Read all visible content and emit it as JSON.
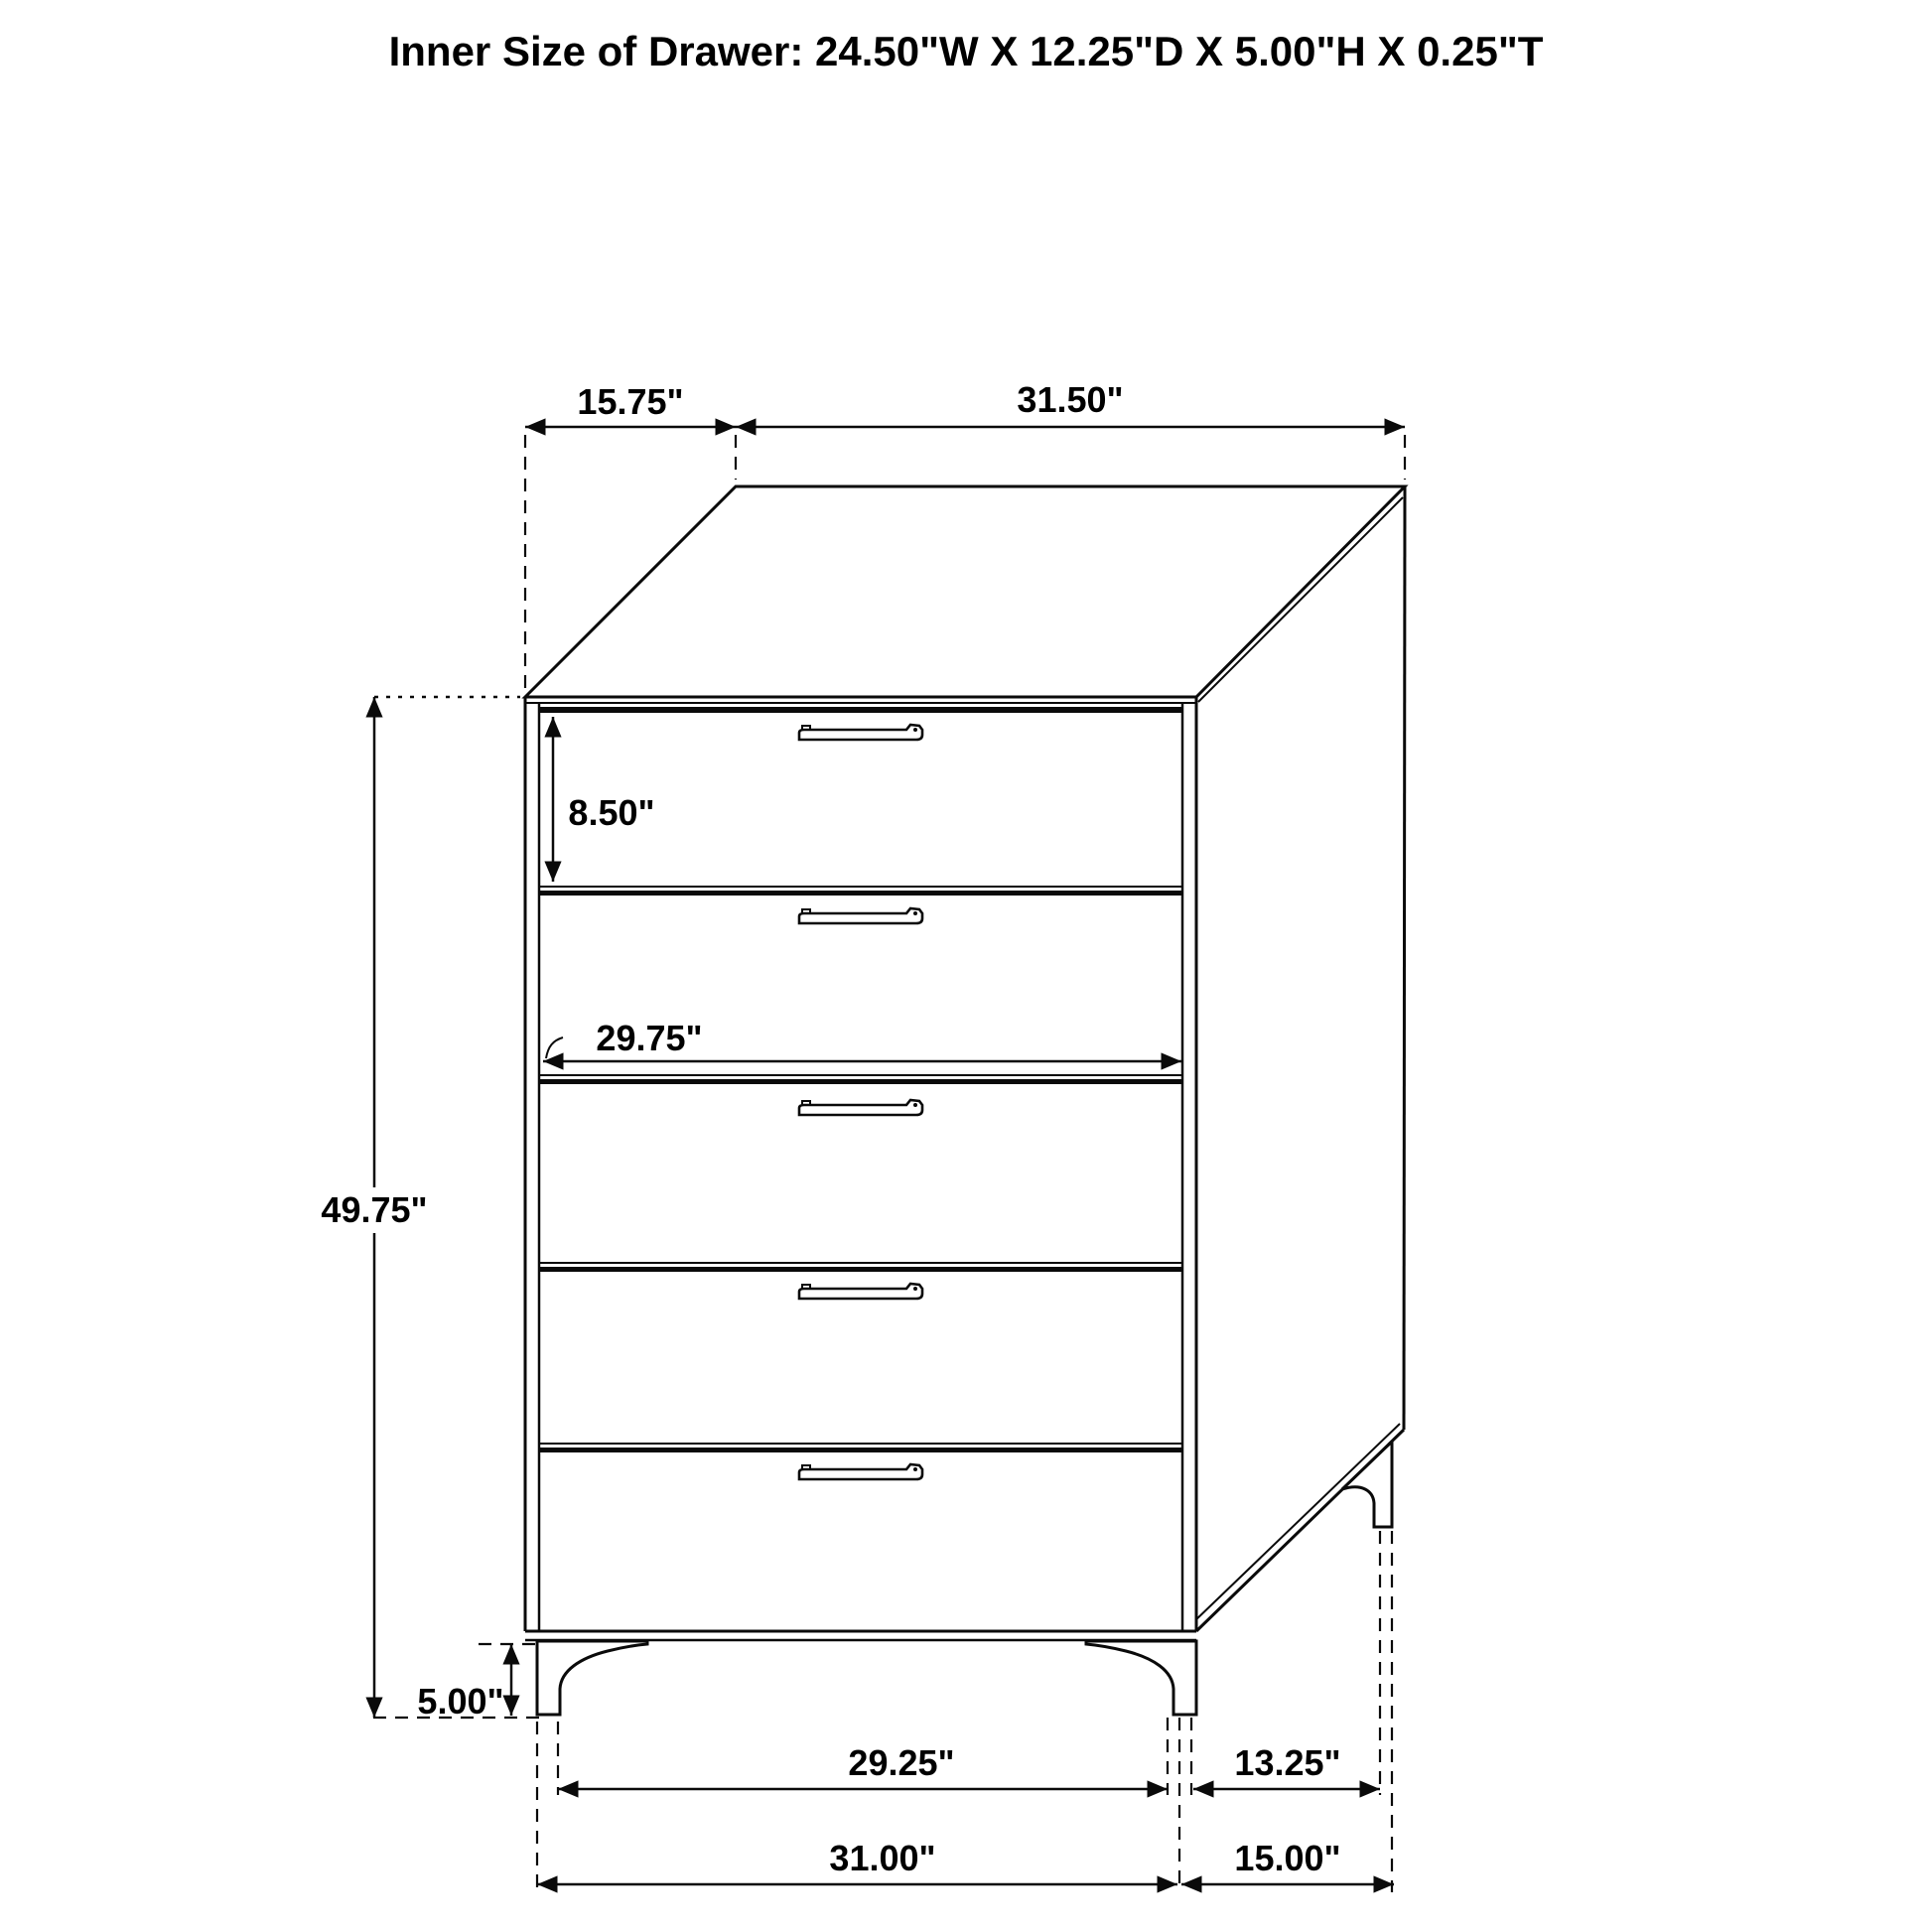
{
  "title": "Inner Size of Drawer: 24.50\"W X 12.25\"D X 5.00\"H X 0.25\"T",
  "labels": {
    "top_depth": "15.75\"",
    "top_width": "31.50\"",
    "first_drawer_height": "8.50\"",
    "drawer_front_width": "29.75\"",
    "overall_height": "49.75\"",
    "leg_height": "5.00\"",
    "front_leg_span": "29.25\"",
    "side_leg_span": "13.25\"",
    "base_width": "31.00\"",
    "base_depth": "15.00\""
  },
  "style": {
    "line_color": "#0a0a0a",
    "background": "#ffffff"
  },
  "drawer_count": 5
}
